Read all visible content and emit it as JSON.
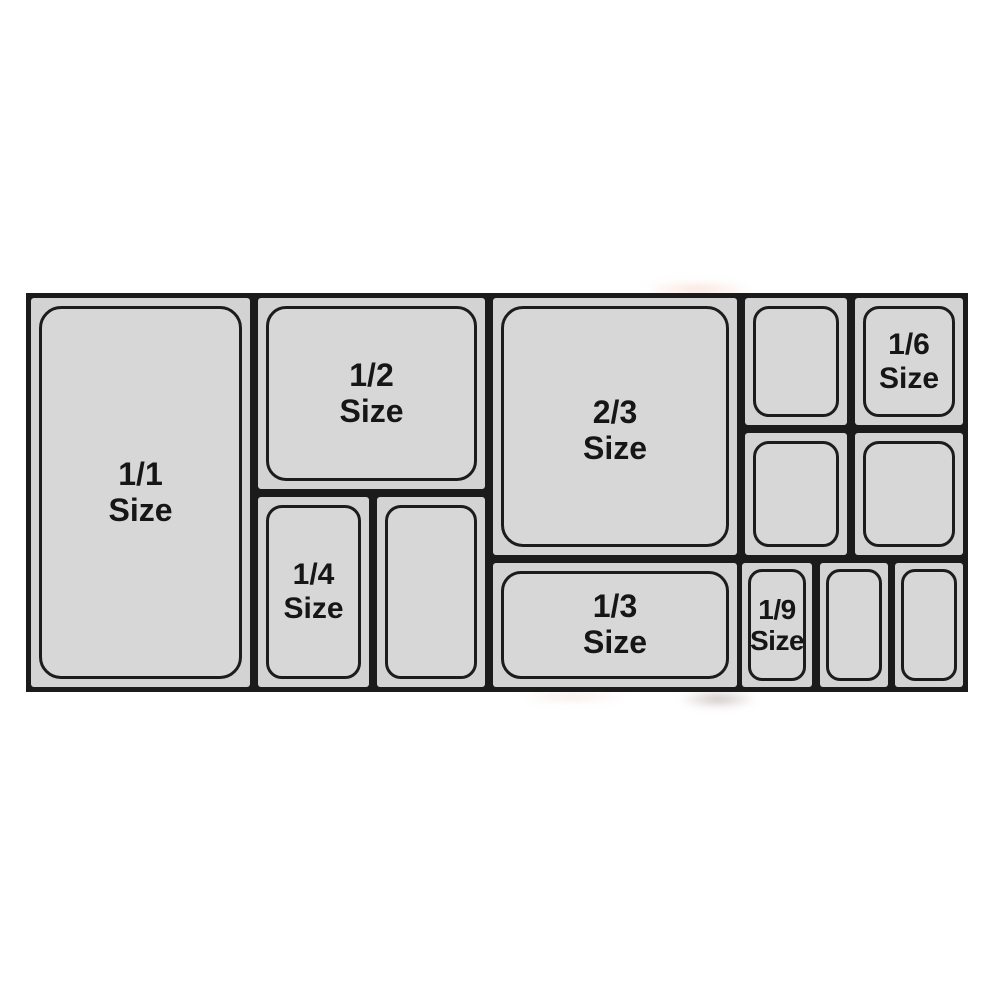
{
  "diagram": {
    "description_labels": {
      "full": {
        "fraction": "1/1",
        "word": "Size"
      },
      "half": {
        "fraction": "1/2",
        "word": "Size"
      },
      "two_thirds": {
        "fraction": "2/3",
        "word": "Size"
      },
      "quarter": {
        "fraction": "1/4",
        "word": "Size"
      },
      "third": {
        "fraction": "1/3",
        "word": "Size"
      },
      "sixth": {
        "fraction": "1/6",
        "word": "Size"
      },
      "ninth": {
        "fraction": "1/9",
        "word": "Size"
      }
    },
    "colors": {
      "background": "#ffffff",
      "grid_line": "#1b1b1b",
      "tile_fill": "#d3d3d3",
      "pan_fill": "#d7d7d7",
      "pan_outline": "#1c1c1c",
      "label_text": "#161616"
    }
  }
}
